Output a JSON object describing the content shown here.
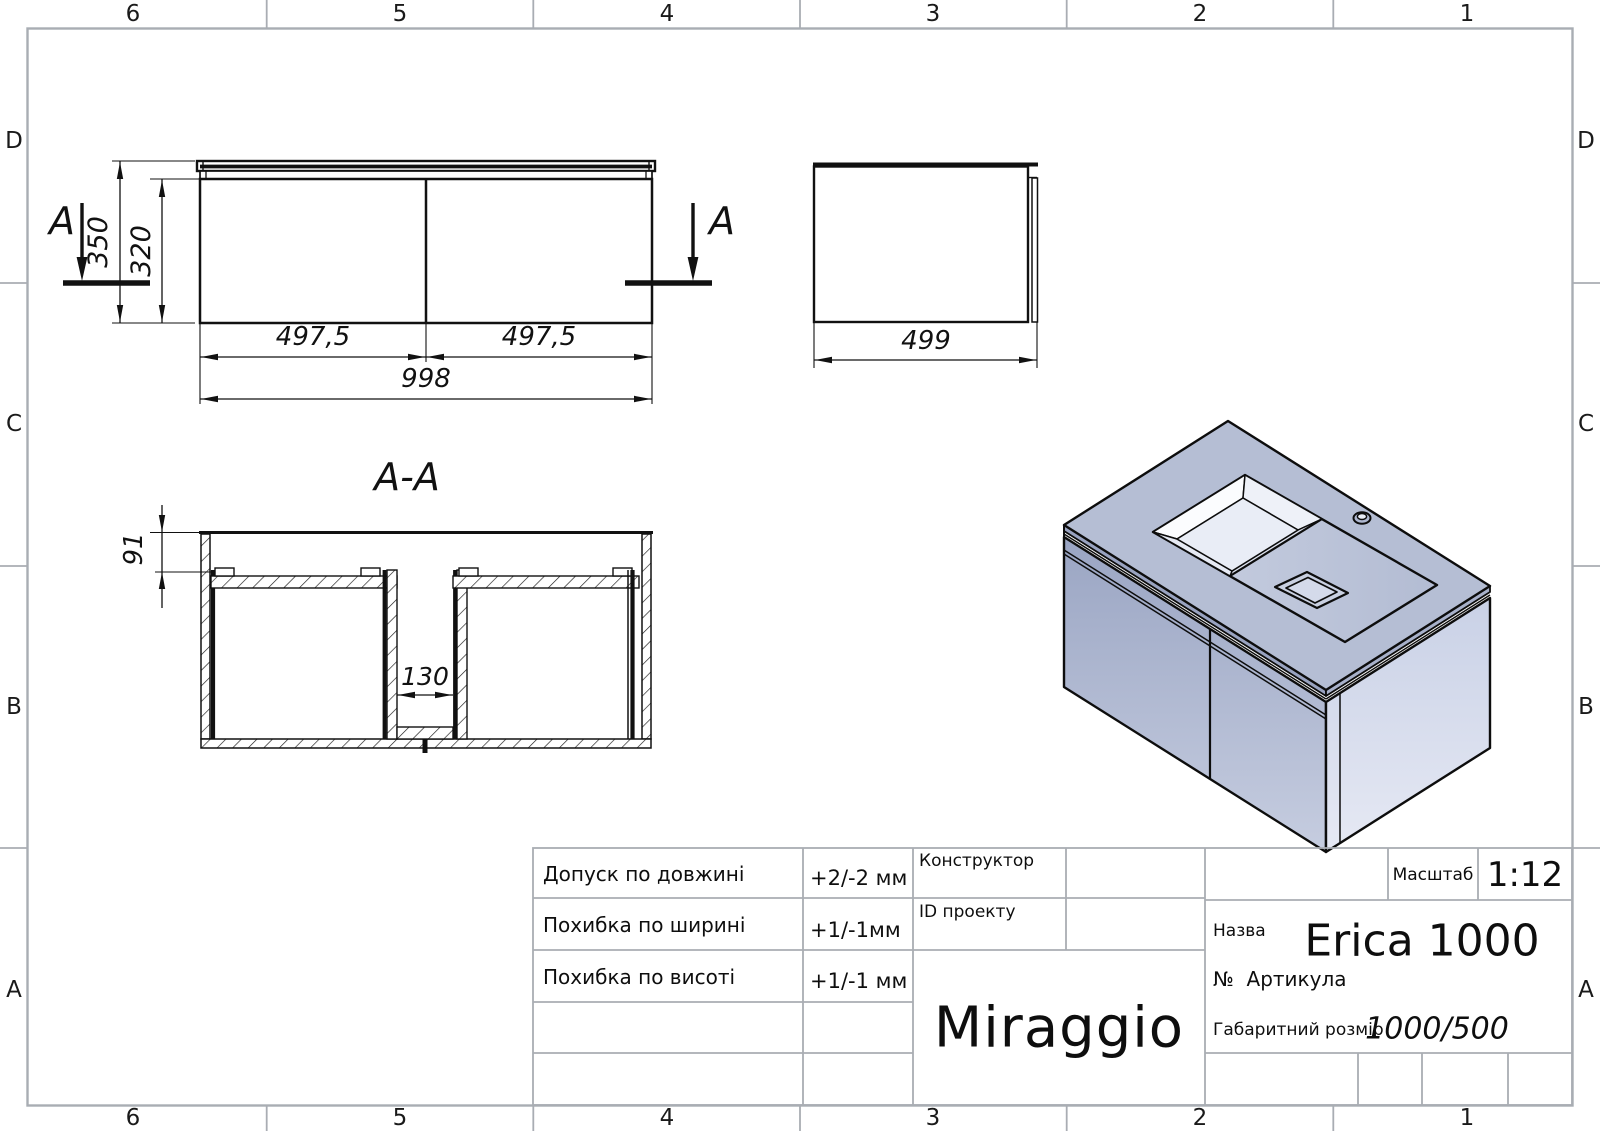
{
  "zones": {
    "columns": [
      "6",
      "5",
      "4",
      "3",
      "2",
      "1"
    ],
    "rows": [
      "D",
      "C",
      "B",
      "A"
    ]
  },
  "views": {
    "front": {
      "section_label": "A",
      "dim_height_total": "350",
      "dim_height_body": "320",
      "dim_width_left": "497,5",
      "dim_width_right": "497,5",
      "dim_width_total": "998"
    },
    "side": {
      "dim_depth": "499"
    },
    "section": {
      "title": "A-A",
      "dim_top_offset": "91",
      "dim_gap": "130"
    }
  },
  "title_block": {
    "tolerances": [
      {
        "label": "Допуск по довжині",
        "value": "+2/-2 мм"
      },
      {
        "label": "Похибка по ширині",
        "value": "+1/-1мм"
      },
      {
        "label": "Похибка по висоті",
        "value": "+1/-1 мм"
      }
    ],
    "constructor_label": "Конструктор",
    "project_id_label": "ID проекту",
    "scale_label": "Масштаб",
    "scale_value": "1:12",
    "name_label": "Назва",
    "name_value": "Erica 1000",
    "article_label": "№  Артикула",
    "size_label": "Габаритний розмір",
    "size_value": "1000/500",
    "brand": "Miraggio"
  },
  "colors": {
    "frame_gray": "#a9adb3",
    "line_black": "#111111",
    "iso_top": "#b5bed4",
    "iso_front_top": "#9aa5c3",
    "iso_front_bottom": "#c6cde0",
    "iso_right_top": "#c9d1e6",
    "iso_right_bottom": "#e6e9f4",
    "iso_basin": "#e9edf6"
  }
}
